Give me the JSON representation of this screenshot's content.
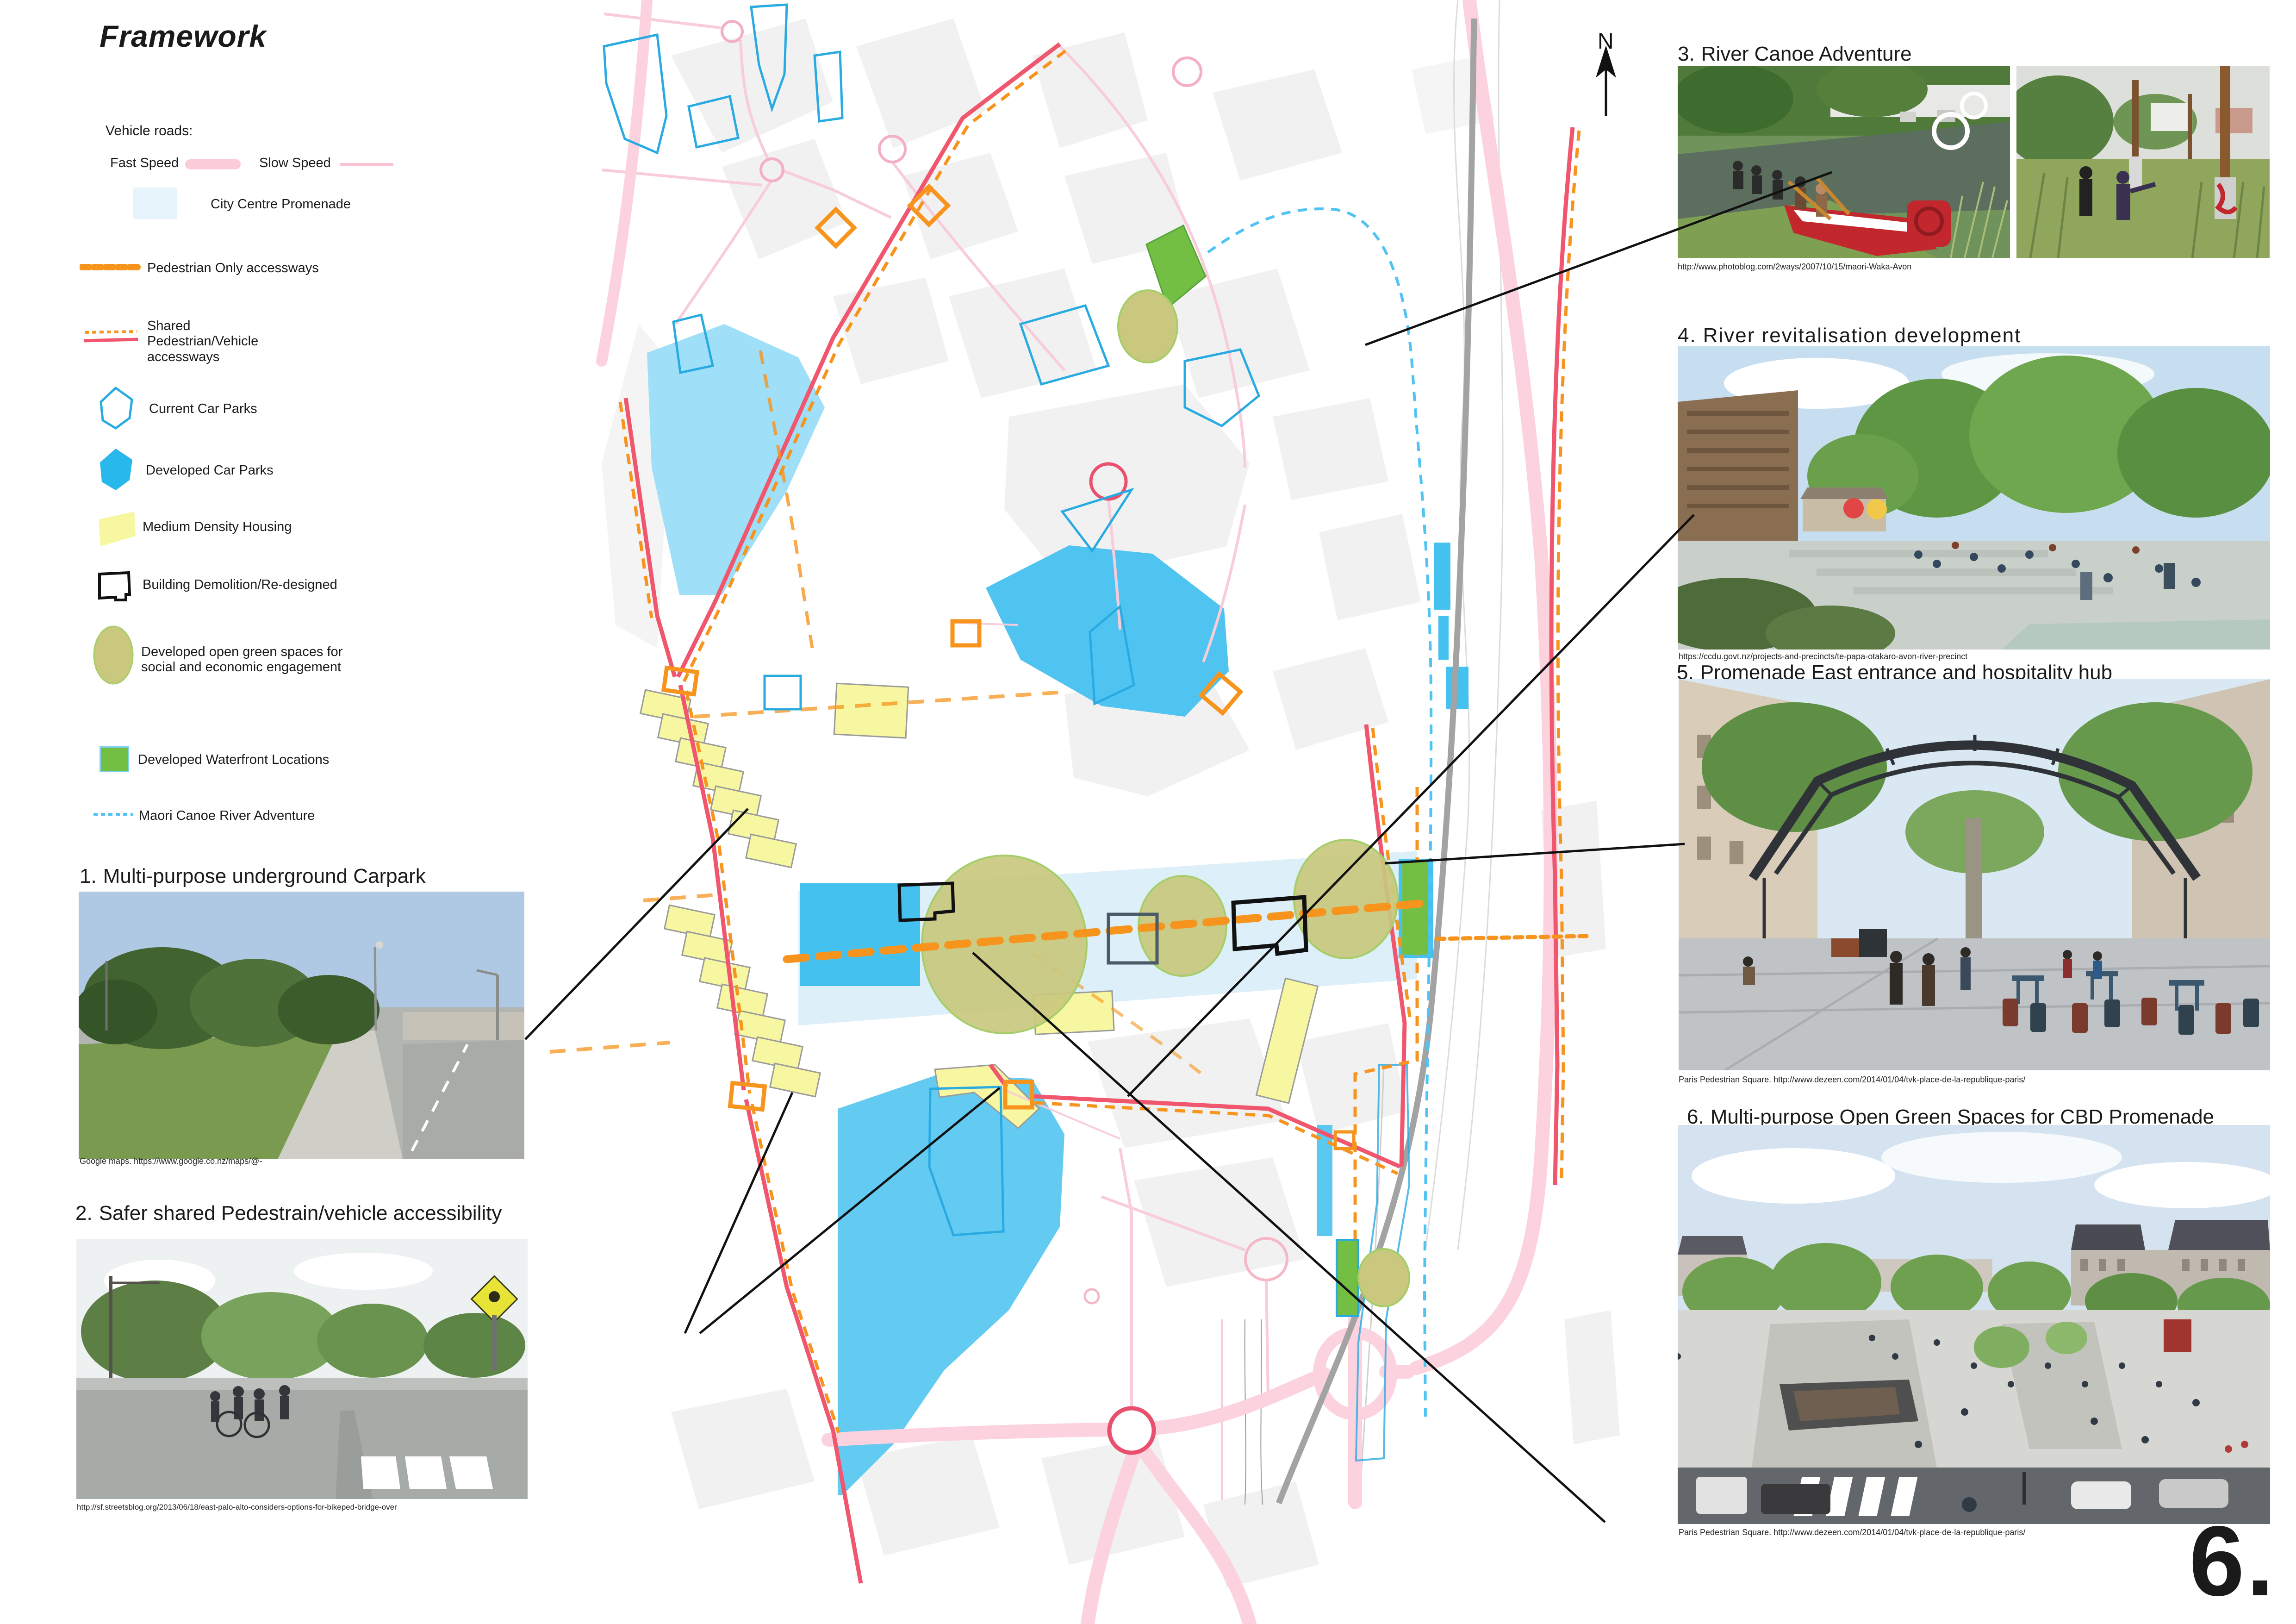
{
  "page": {
    "title": "Framework",
    "number": "6."
  },
  "north_label": "N",
  "legend": {
    "heading": "Vehicle roads:",
    "rows": [
      {
        "id": "fast-speed",
        "label": "Fast Speed"
      },
      {
        "id": "slow-speed",
        "label": "Slow  Speed"
      },
      {
        "id": "promenade",
        "label": "City Centre Promenade"
      },
      {
        "id": "pedestrian-only",
        "label": "Pedestrian Only  accessways"
      },
      {
        "id": "shared-access",
        "label": "Shared Pedestrian/Vehicle accessways"
      },
      {
        "id": "current-carparks",
        "label": "Current Car Parks"
      },
      {
        "id": "developed-carparks",
        "label": "Developed Car Parks"
      },
      {
        "id": "housing",
        "label": "Medium Density Housing"
      },
      {
        "id": "demolition",
        "label": "Building Demolition/Re-designed"
      },
      {
        "id": "green-spaces",
        "label": "Developed open green spaces for social and economic engagement"
      },
      {
        "id": "waterfront",
        "label": "Developed Waterfront Locations"
      },
      {
        "id": "maori-canoe",
        "label": "Maori Canoe River Adventure"
      }
    ]
  },
  "callouts": [
    {
      "num": "1.",
      "title": "Multi-purpose underground Carpark",
      "credit": "Google maps. https://www.google.co.nz/maps/@-"
    },
    {
      "num": "2.",
      "title": "Safer shared Pedestrain/vehicle accessibility",
      "credit": "http://sf.streetsblog.org/2013/06/18/east-palo-alto-considers-options-for-bikeped-bridge-over"
    },
    {
      "num": "3.",
      "title": "River  Canoe Adventure",
      "credit": "http://www.photoblog.com/2ways/2007/10/15/maori-Waka-Avon"
    },
    {
      "num": "4.",
      "title": "River revitalisation development",
      "credit": "https://ccdu.govt.nz/projects-and-precincts/te-papa-otakaro-avon-river-precinct"
    },
    {
      "num": "5.",
      "title": "Promenade East entrance and hospitality hub",
      "credit": "Paris Pedestrian Square. http://www.dezeen.com/2014/01/04/tvk-place-de-la-republique-paris/"
    },
    {
      "num": "6.",
      "title": "Multi-purpose Open Green Spaces for CBD Promenade",
      "credit": "Paris Pedestrian Square. http://www.dezeen.com/2014/01/04/tvk-place-de-la-republique-paris/"
    }
  ],
  "colors": {
    "fast_road_pink": "#FBD2DE",
    "slow_road_pink": "#F9C3D2",
    "shared_access_red": "#F0566E",
    "pedestrian_orange": "#F7941D",
    "promenade_light_blue": "#D9EDF8",
    "carpark_outline_blue": "#29ABE2",
    "carpark_fill_cyan": "#45C1F0",
    "housing_yellow": "#F7F6A1",
    "green_space_olive": "#C9C87E",
    "waterfront_green": "#72BF44",
    "maori_route_blue": "#4FC3F4",
    "railway_gray": "#A3A3A3",
    "demolition_black": "#111111"
  }
}
